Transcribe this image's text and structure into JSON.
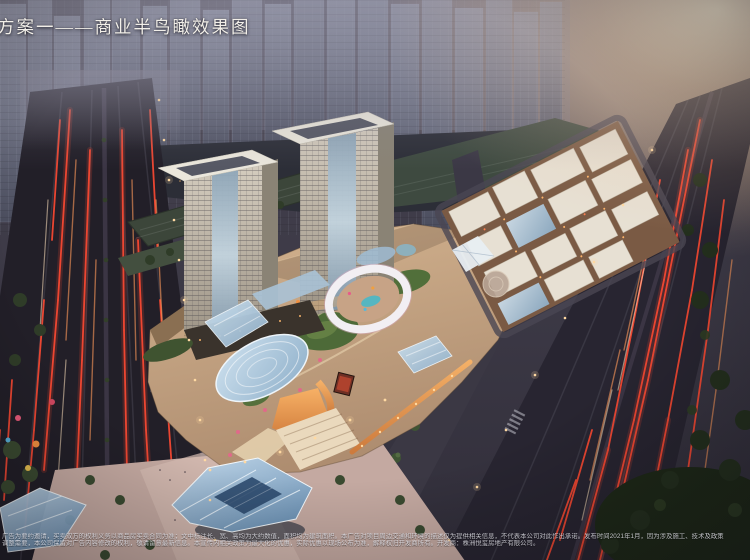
{
  "title": "方案一——商业半鸟瞰效果图",
  "disclaimer": {
    "line1": "广告为要约邀请，买卖双方的权利义务以商品房买卖合同为准；文中标注长、宽、高均为大约数值，面积均为建筑面积。本广告对项目周边交通和环境的描述仅为提供相关信息，不代表本公司对此作出承诺。发布时间2021年1月，因为涉及施工、技术及政策",
    "line2": "调整需要，本公司保留对广告内容修改的权利，敬请留意最新信息。本宣传内相关政策为最大化的优惠，实际优惠以现场公布为准，解释权归开发商所有。开发商：株洲悦玺房地产有限公司。"
  },
  "publish_date": "2021年1月",
  "developer": "株洲悦玺房地产有限公司",
  "colors": {
    "title_color": "#f2efe9",
    "disclaimer_color": "#dcdce3",
    "trail_red": "#ff4a32",
    "trail_amber": "#ff9a5a",
    "trail_white": "#ffe2bd",
    "dusk_sky": "#55525f",
    "warm_haze": "#f4e3c4",
    "roof_tan": "#c9a887",
    "garden_green": "#4d6a38",
    "canopy_blue": "#b5cfe2",
    "ring_white": "#f2eff3",
    "orange_glow": "#e8954a"
  }
}
